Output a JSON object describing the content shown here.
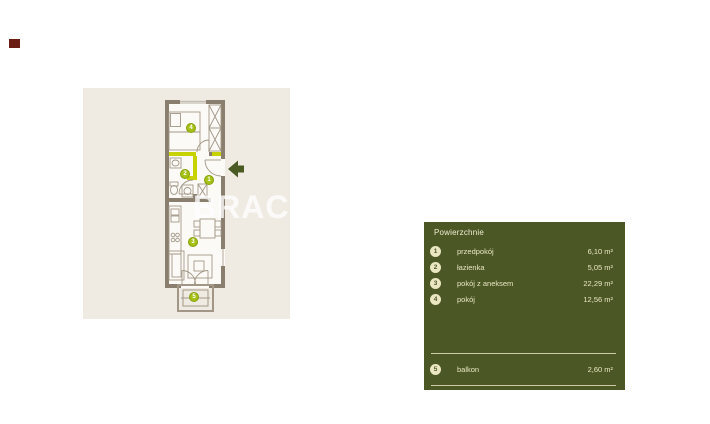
{
  "marker": {
    "color": "#6b1c13"
  },
  "floorplan": {
    "watermark": "BRACIA",
    "panel_color": "#f0ebe2",
    "wall_color": "#8a7e6e",
    "highlight_color": "#c6d300",
    "marker_color": "#a5c117",
    "entrance_arrow_color": "#4a5a23",
    "room_markers": [
      "1",
      "2",
      "3",
      "4",
      "5"
    ]
  },
  "legend": {
    "title": "Powierzchnie",
    "panel_color": "#4b5826",
    "text_color": "#ebe6c2",
    "rows": [
      {
        "num": "1",
        "label": "przedpokój",
        "value": "6,10 m²"
      },
      {
        "num": "2",
        "label": "łazienka",
        "value": "5,05 m²"
      },
      {
        "num": "3",
        "label": "pokój z aneksem",
        "value": "22,29 m²"
      },
      {
        "num": "4",
        "label": "pokój",
        "value": "12,56 m²"
      }
    ],
    "balcony_row": {
      "num": "5",
      "label": "balkon",
      "value": "2,60 m²"
    }
  }
}
